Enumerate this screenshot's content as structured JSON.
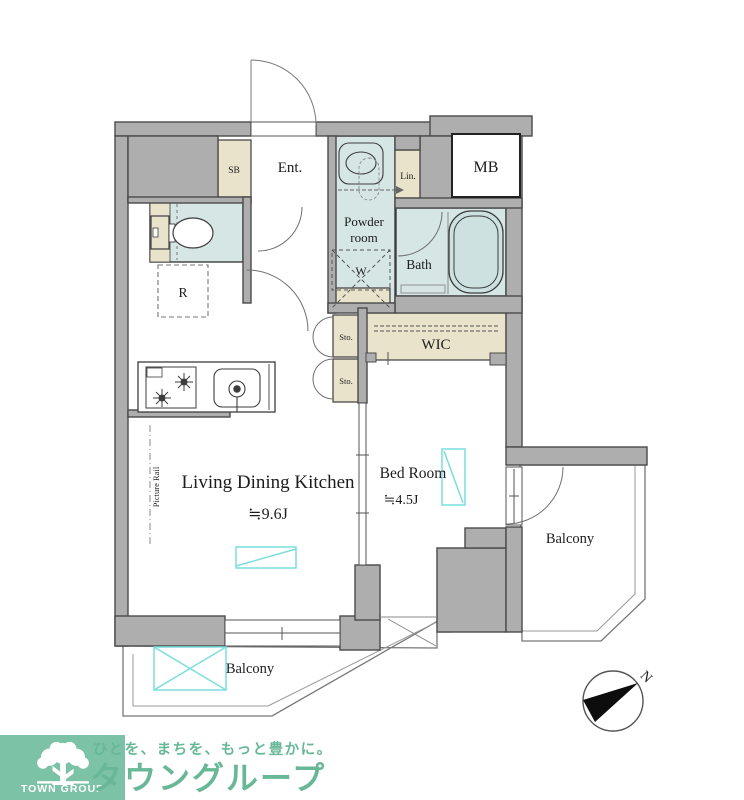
{
  "plan": {
    "labels": {
      "ent": "Ent.",
      "sb": "SB",
      "powder_line1": "Powder",
      "powder_line2": "room",
      "lin": "Lin.",
      "mb": "MB",
      "bath": "Bath",
      "washer": "W",
      "fridge": "R",
      "sto_upper": "Sto.",
      "sto_lower": "Sto.",
      "wic": "WIC",
      "ldk": "Living Dining Kitchen",
      "ldk_area": "≒9.6J",
      "bedroom": "Bed Room",
      "bedroom_area": "≒4.5J",
      "balcony_right": "Balcony",
      "balcony_bottom": "Balcony",
      "picture_rail": "Picture Rail",
      "north": "N"
    },
    "colors": {
      "wall_fill": "#aeaeae",
      "wet_room_fill": "#d5e6e4",
      "cabinet_fill": "#eae3cb",
      "window_symbol": "#7adede",
      "line_dark": "#3d3d3d"
    }
  },
  "footer": {
    "logo_caption": "TOWN GROUP",
    "slogan": "ひとを、まちを、もっと豊かに。",
    "company": "タウングループ",
    "brand_green": "#68b897",
    "logo_bg": "#7cc2a6"
  }
}
